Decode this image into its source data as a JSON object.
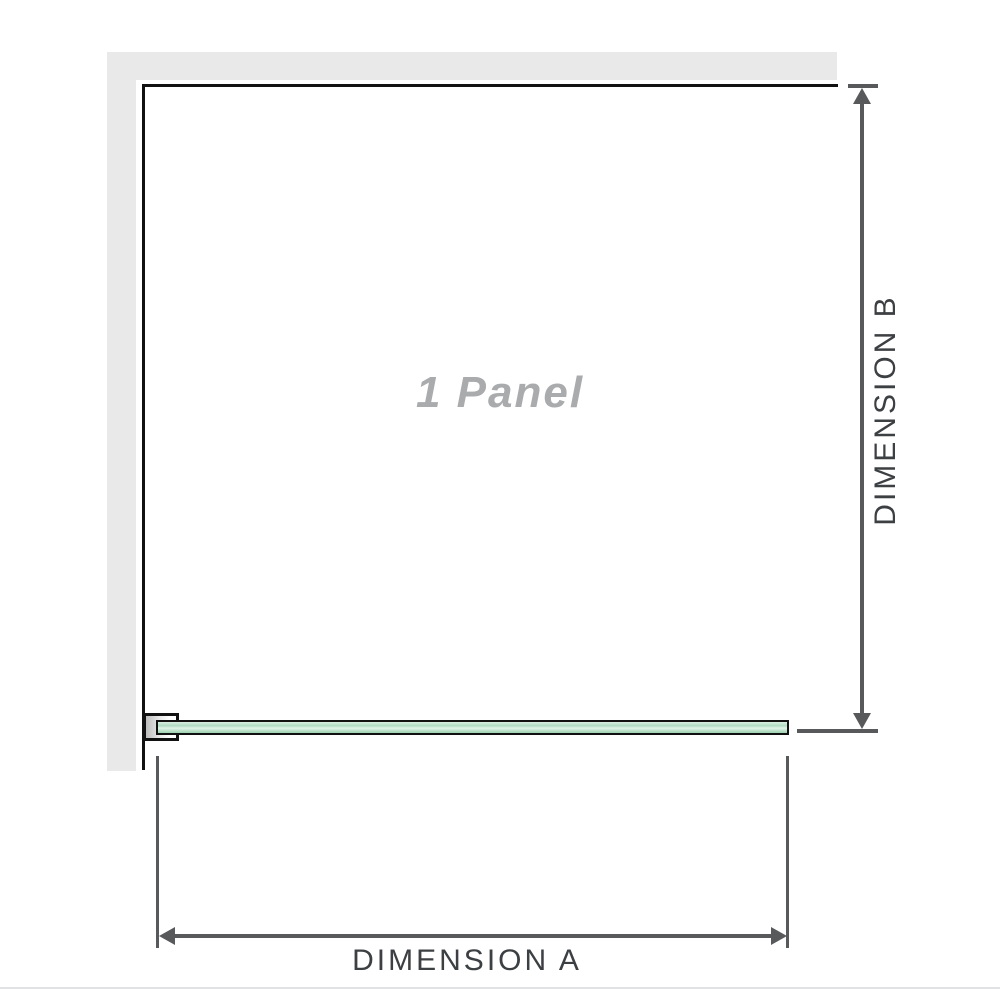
{
  "diagram": {
    "panel_label": "1 Panel",
    "dimension_a_label": "DIMENSION A",
    "dimension_b_label": "DIMENSION B"
  },
  "icons": {
    "dimension_b_arrow": "vertical-double-arrow",
    "dimension_a_arrow": "horizontal-double-arrow"
  },
  "colors": {
    "background": "#ffffff",
    "wall": "#e9e9e9",
    "outline": "#111111",
    "dimension": "#58595b",
    "label_text": "#3d4043",
    "panel_text": "#a9abad",
    "glass_light": "#d8efe2",
    "glass_mid": "#b0dcc0",
    "glass_dark": "#9dd2af",
    "divider": "#e0e2e4"
  }
}
